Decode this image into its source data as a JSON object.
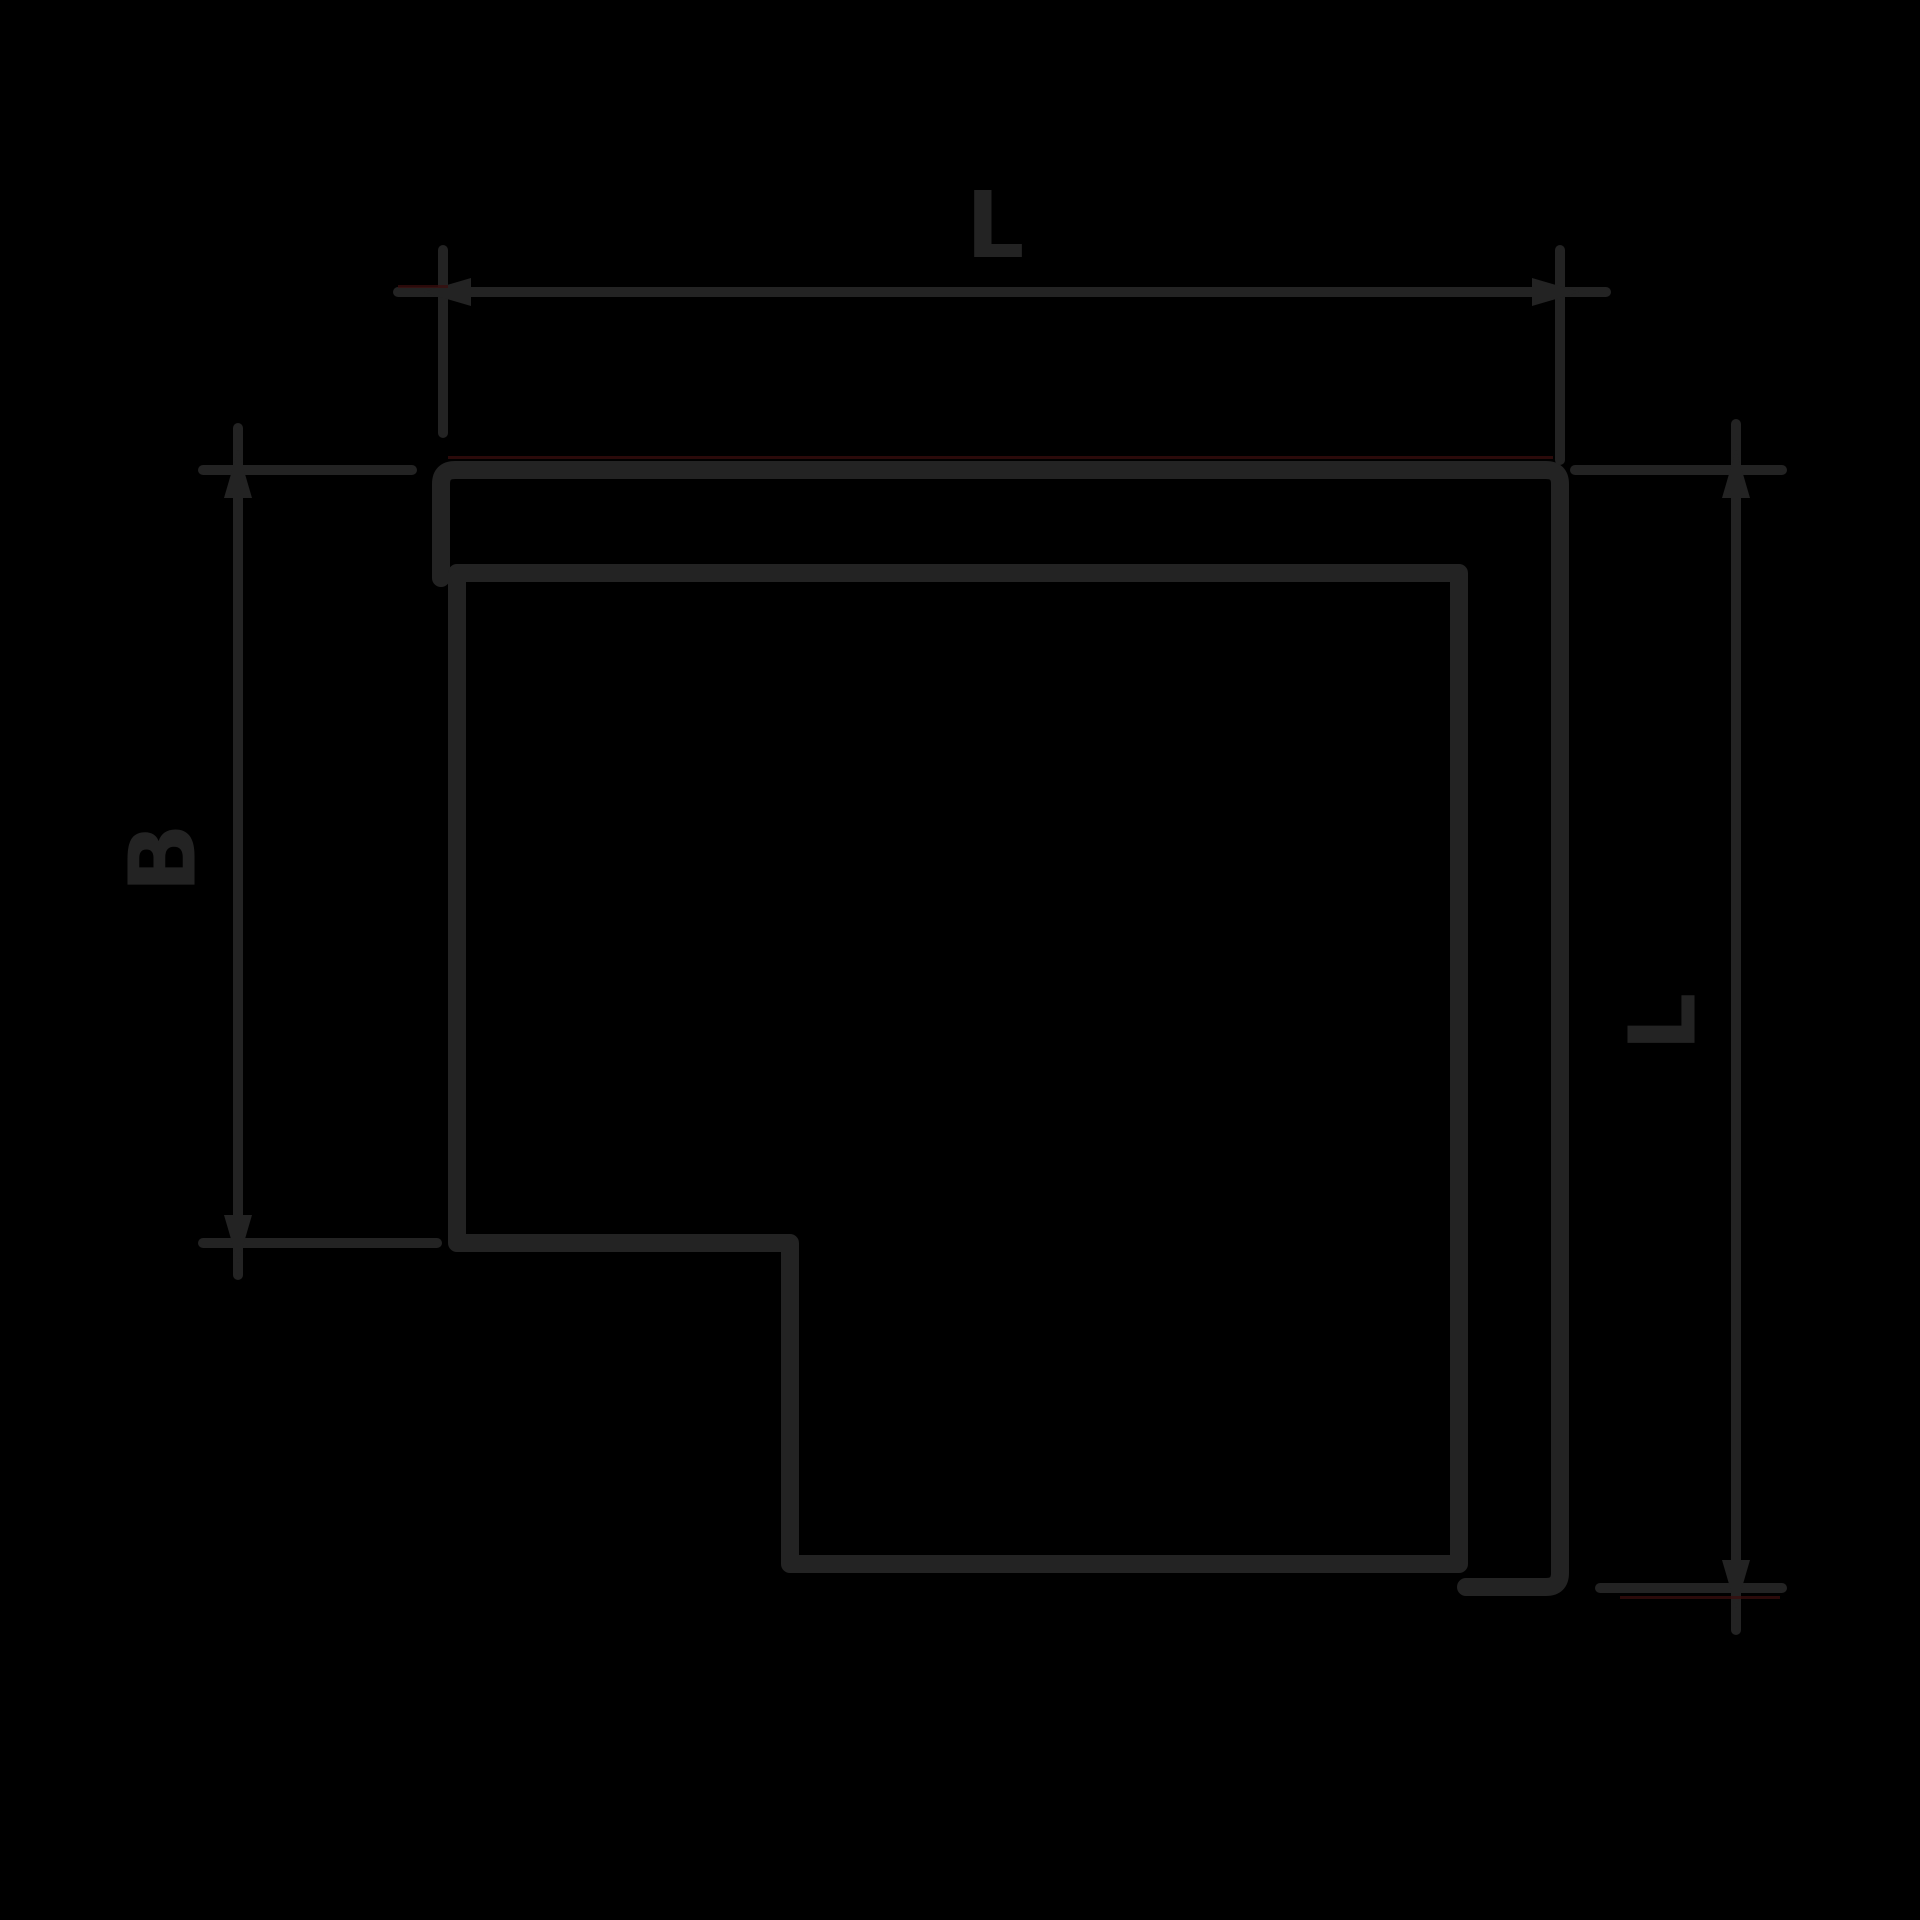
{
  "page": {
    "width": 1920,
    "height": 1920,
    "background": "#000000"
  },
  "drawing": {
    "kind": "technical-dimension-drawing",
    "subject": "flat 90-degree corner piece (L-shaped elbow) with overlapping cover outline",
    "labels": {
      "top_dimension": "L",
      "left_dimension": "B",
      "right_dimension": "L"
    },
    "colors": {
      "background": "#000000",
      "line": "#232323",
      "text": "#232323",
      "artifact_red": "#3a0e0e"
    }
  }
}
